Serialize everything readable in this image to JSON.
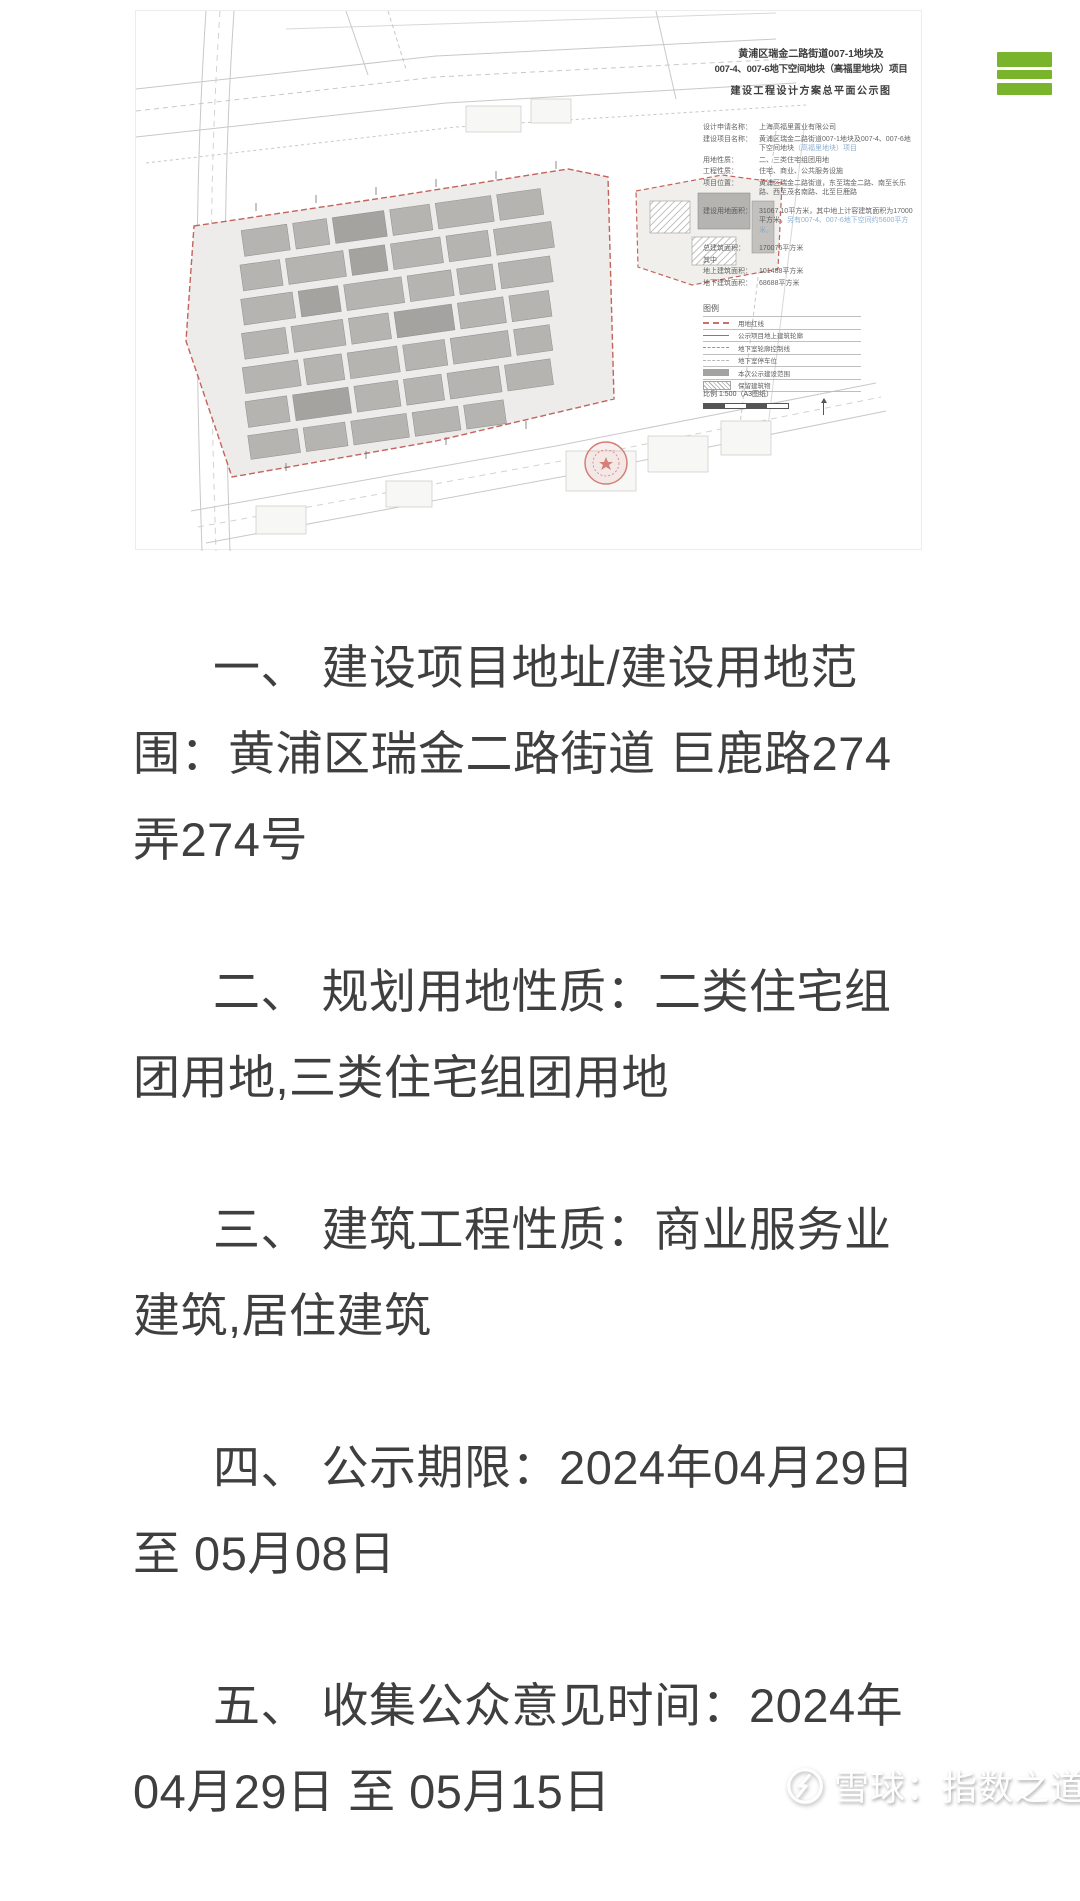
{
  "header": {
    "menu_color": "#79b42c"
  },
  "notice_image": {
    "title_line1": "黄浦区瑞金二路街道007-1地块及",
    "title_line2": "007-4、007-6地下空间地块（高福里地块）项目",
    "title_line3": "建设工程设计方案总平面公示图",
    "info_rows": [
      {
        "label": "设计申请名称：",
        "value": "上海高福里置业有限公司"
      },
      {
        "label": "建设项目名称：",
        "value": "黄浦区瑞金二路街道007-1地块及007-4、007-6地下空间地块",
        "hl": "（高福里地块）项目"
      },
      {
        "label": "用地性质：",
        "value": "二、三类住宅组团用地"
      },
      {
        "label": "工程性质：",
        "value": "住宅、商业、公共服务设施"
      },
      {
        "label": "项目位置：",
        "value": "黄浦区瑞金二路街道，东至瑞金二路、南至长乐路、西至茂名南路、北至巨鹿路"
      },
      {
        "label": "建设用地面积：",
        "value": "31067.10平方米，其中地上计容建筑面积为17000平方米，",
        "hl": "另有007-4、007-6地下空间约5600平方米。"
      },
      {
        "label": "总建筑面积：",
        "value": "170076平方米"
      },
      {
        "label": "其中",
        "value": ""
      },
      {
        "label": "地上建筑面积：",
        "value": "101488平方米"
      },
      {
        "label": "地下建筑面积：",
        "value": "68688平方米"
      }
    ],
    "legend": {
      "header": "图例",
      "items": [
        {
          "label": "用地红线"
        },
        {
          "label": "公示项目地上建筑轮廓"
        },
        {
          "label": "地下室轮廓控制线"
        },
        {
          "label": "地下室停车位"
        },
        {
          "label": "本次公示建设范围"
        },
        {
          "label": "保留建筑物"
        }
      ]
    },
    "scale_label": "比例 1:500（A3图纸）"
  },
  "article": {
    "paragraphs": [
      {
        "lines": [
          "一、 建设项目地址/建设用地范",
          "围：黄浦区瑞金二路街道 巨鹿路274",
          "弄274号"
        ]
      },
      {
        "lines": [
          "二、 规划用地性质：二类住宅组",
          "团用地,三类住宅组团用地"
        ]
      },
      {
        "lines": [
          "三、 建筑工程性质：商业服务业",
          "建筑,居住建筑"
        ]
      },
      {
        "lines": [
          "四、 公示期限：2024年04月29日",
          "至 05月08日"
        ]
      },
      {
        "lines": [
          "五、 收集公众意见时间：2024年",
          "04月29日 至 05月15日"
        ]
      }
    ]
  },
  "watermark": {
    "text": "雪球：指数之道"
  }
}
